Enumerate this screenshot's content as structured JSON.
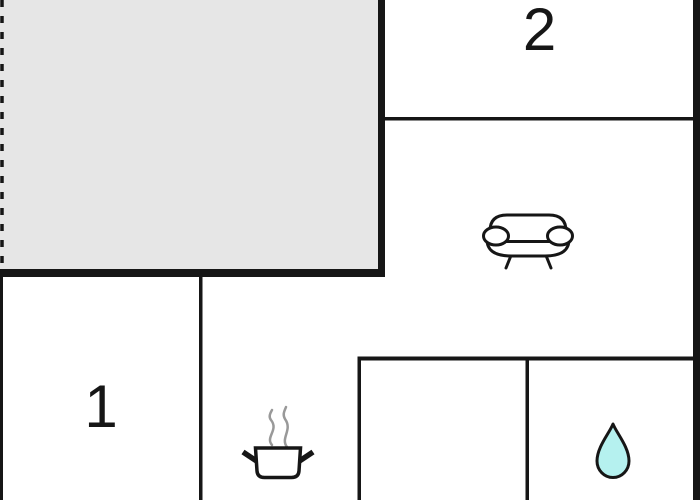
{
  "floorplan": {
    "kind": "apartment-floor-plan",
    "room_labels": {
      "room1": "1",
      "room2": "2"
    },
    "icons": {
      "sofa": "sofa-icon",
      "stove": "steaming-pot-icon",
      "water_drop": "water-drop-icon"
    },
    "colors": {
      "wall": "#161616",
      "terrace_fill": "#e6e6e6",
      "water_drop_fill": "#b5f1ef",
      "steam": "#999999",
      "background": "#ffffff"
    }
  }
}
